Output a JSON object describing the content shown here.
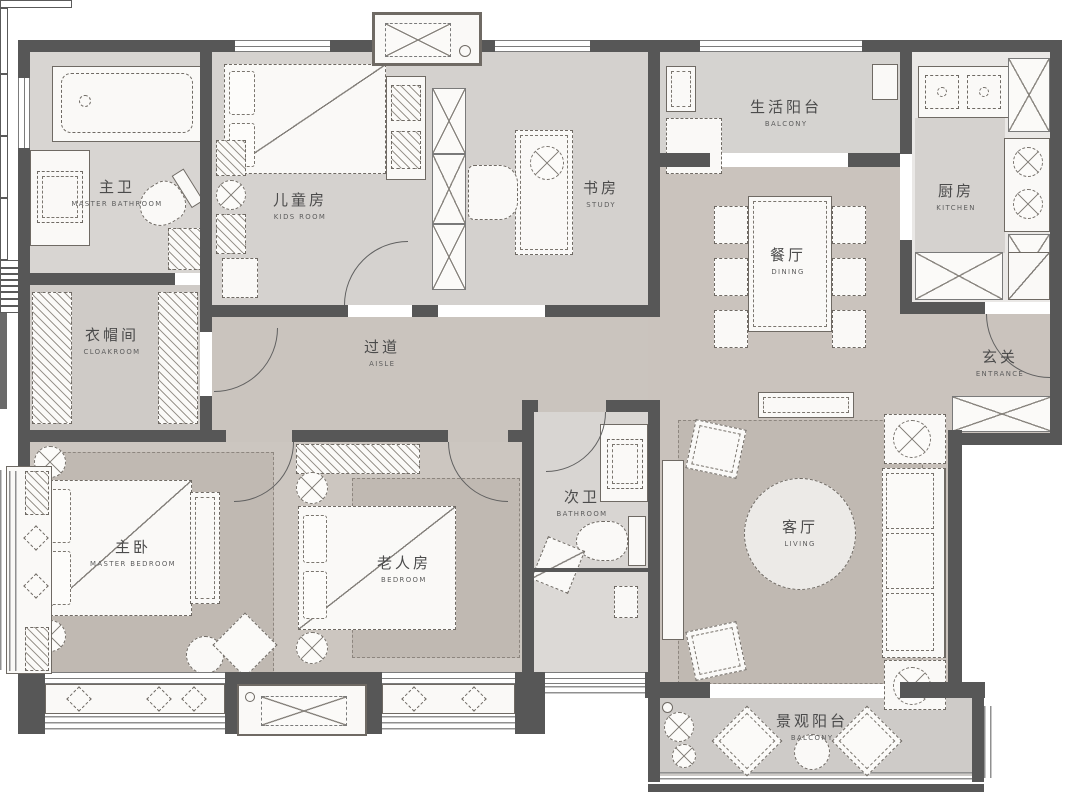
{
  "title": "apartment-floor-plan",
  "colors": {
    "wall": "#575757",
    "floor_light": "#d7d4d1",
    "floor_taupe": "#cac3bd",
    "rug": "#c0b9b2",
    "furniture_fill": "#faf9f7",
    "outline": "#6f6a64",
    "label_text": "#4b4b4b"
  },
  "rooms": {
    "master_bath": {
      "zh": "主卫",
      "en": "MASTER BATHROOM"
    },
    "cloakroom": {
      "zh": "衣帽间",
      "en": "CLOAKROOM"
    },
    "kids": {
      "zh": "儿童房",
      "en": "KIDS ROOM"
    },
    "study": {
      "zh": "书房",
      "en": "STUDY"
    },
    "life_balcony": {
      "zh": "生活阳台",
      "en": "BALCONY"
    },
    "kitchen": {
      "zh": "厨房",
      "en": "KITCHEN"
    },
    "dining": {
      "zh": "餐厅",
      "en": "DINING"
    },
    "entrance": {
      "zh": "玄关",
      "en": "ENTRANCE"
    },
    "aisle": {
      "zh": "过道",
      "en": "AISLE"
    },
    "master_bedroom": {
      "zh": "主卧",
      "en": "MASTER BEDROOM"
    },
    "elder_bedroom": {
      "zh": "老人房",
      "en": "BEDROOM"
    },
    "second_bath": {
      "zh": "次卫",
      "en": "BATHROOM"
    },
    "living": {
      "zh": "客厅",
      "en": "LIVING"
    },
    "view_balcony": {
      "zh": "景观阳台",
      "en": "BALCONY"
    }
  }
}
